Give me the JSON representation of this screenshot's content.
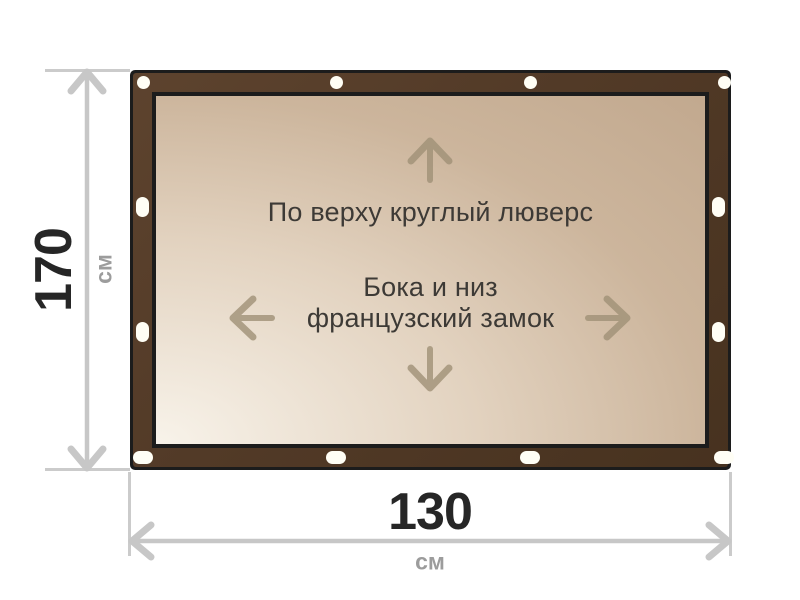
{
  "product_diagram": {
    "type": "banner-tarpaulin-scheme",
    "labels": {
      "top": "По верху круглый люверс",
      "center_line1": "Бока и низ",
      "center_line2": "французский замок"
    },
    "dimensions": {
      "height": {
        "value": "170",
        "unit": "см"
      },
      "width": {
        "value": "130",
        "unit": "см"
      }
    },
    "grommets": {
      "top_count": 4,
      "bottom_count": 4,
      "left_count": 2,
      "right_count": 2
    },
    "colors": {
      "frame_brown": "#523a27",
      "frame_outline": "#1c1c1c",
      "tarp_light": "#f8f3ea",
      "tarp_dark": "#c2a98f",
      "grommet": "#fffef5",
      "dimension_arrow": "#c7c7c7",
      "dimension_value_text": "#262626",
      "unit_text": "#9c9c9c",
      "inner_arrow": "#a09177",
      "inner_text": "#3d3a36"
    }
  }
}
